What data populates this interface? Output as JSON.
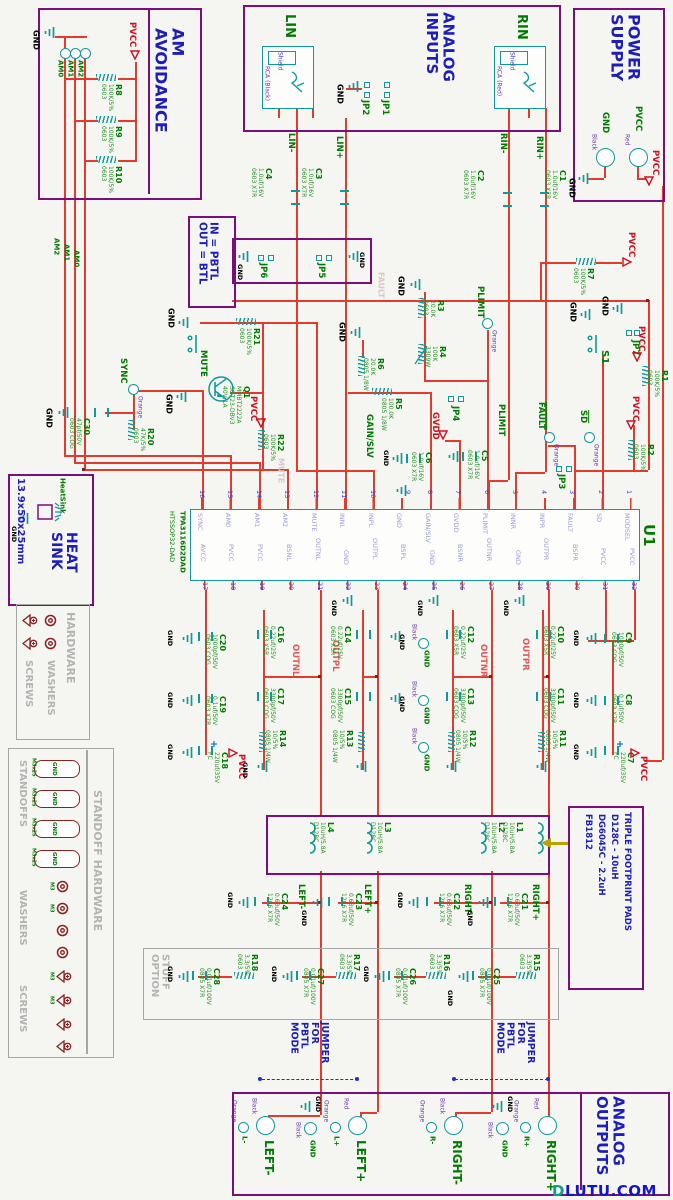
{
  "colors": {
    "wire": "#e23b2e",
    "symbol": "#0f9b9b",
    "block_border": "#7c0d7c",
    "title_blue": "#1d1dbb",
    "designator_green": "#007a00",
    "power_red": "#cf1020",
    "gray": "#a6a6a6",
    "hardware_red": "#8b2020",
    "jumper_blue": "#2a2ac8",
    "footprint_arrow": "#b8a400"
  },
  "watermark": {
    "d": "D",
    "rest": "LUTU.COM"
  },
  "titles": {
    "am": "AM\nAVOIDANCE",
    "inputs": "ANALOG\nINPUTS",
    "power": "POWER\nSUPPLY",
    "pbtl": "IN = PBTL\nOUT = BTL",
    "heat": "HEAT\nSINK",
    "heat_sub": "13.9x50x25mm",
    "heat_tag": "HeatSink",
    "hardware": "HARDWARE",
    "washers": "WASHERS",
    "screws": "SCREWS",
    "standoff": "STANDOFF HARDWARE",
    "standoffs": "STANDOFFS",
    "stuff": "STUFF\nOPTION",
    "jumper": "JUMPER\nFOR\nPBTL\nMODE",
    "outputs": "ANALOG\nOUTPUTS",
    "tfp1": "TRIPLE FOOTPRINT PADS",
    "tfp2": "D128C - 10uH",
    "tfp3": "DG6045C - 2.2uH",
    "tfp4": "FB1812",
    "m3": "M3",
    "m3x25": "M3x25"
  },
  "nets": {
    "gnd": "GND",
    "pvcc": "PVCC",
    "gvdd": "GVDD",
    "linn": "LIN-",
    "linp": "LIN+",
    "rinn": "RIN-",
    "rinp": "RIN+",
    "am0": "AM0",
    "am1": "AM1",
    "am2": "AM2",
    "outnl": "OUTNL",
    "outpl": "OUTPL",
    "outnr": "OUTNR",
    "outpr": "OUTPR",
    "leftn": "LEFT-",
    "leftp": "LEFT+",
    "rightn": "RIGHT-",
    "rightp": "RIGHT+",
    "gain": "GAIN/SLV",
    "plimit": "PLIMIT",
    "mute": "MUTE",
    "sync": "SYNC",
    "sd": "SD",
    "fault": "FAULT",
    "ln": "L-",
    "lp": "L+",
    "rn": "R-",
    "rp": "R+"
  },
  "tp_colors": {
    "orange": "Orange",
    "black": "Black",
    "red": "Red"
  },
  "rca": {
    "lin": "LIN",
    "rin": "RIN",
    "shield": "Shield",
    "black": "RCA (Black)",
    "red": "RCA (Red)"
  },
  "u1": {
    "r": "U1",
    "part": "TPA3116D2DAD",
    "pkg": "HTSSOP32-DAD",
    "top": [
      {
        "n": "16",
        "s": "SYNC"
      },
      {
        "n": "15",
        "s": "AM0"
      },
      {
        "n": "14",
        "s": "AM1"
      },
      {
        "n": "13",
        "s": "AM2"
      },
      {
        "n": "12",
        "s": "MUTE"
      },
      {
        "n": "11",
        "s": "INNL"
      },
      {
        "n": "10",
        "s": "INPL"
      },
      {
        "n": "9",
        "s": "GND"
      },
      {
        "n": "8",
        "s": "GAIN/SLV"
      },
      {
        "n": "7",
        "s": "GVDD"
      },
      {
        "n": "6",
        "s": "PLIMIT"
      },
      {
        "n": "5",
        "s": "INNR"
      },
      {
        "n": "4",
        "s": "INPR"
      },
      {
        "n": "3",
        "s": "FAULT"
      },
      {
        "n": "2",
        "s": "SD"
      },
      {
        "n": "1",
        "s": "MODSEL"
      }
    ],
    "bot": [
      {
        "n": "17",
        "s": "AVCC"
      },
      {
        "n": "18",
        "s": "PVCC"
      },
      {
        "n": "19",
        "s": "PVCC"
      },
      {
        "n": "20",
        "s": "BSNL"
      },
      {
        "n": "21",
        "s": "OUTNL"
      },
      {
        "n": "22",
        "s": "GND"
      },
      {
        "n": "23",
        "s": "OUTPL"
      },
      {
        "n": "24",
        "s": "BSPL"
      },
      {
        "n": "25",
        "s": "GND"
      },
      {
        "n": "26",
        "s": "BSNR"
      },
      {
        "n": "27",
        "s": "OUTNR"
      },
      {
        "n": "28",
        "s": "GND"
      },
      {
        "n": "29",
        "s": "OUTPR"
      },
      {
        "n": "30",
        "s": "BSPR"
      },
      {
        "n": "31",
        "s": "PVCC"
      },
      {
        "n": "32",
        "s": "PVCC"
      }
    ]
  },
  "components": {
    "R1": {
      "r": "R1",
      "v": "100K/5%\n0603"
    },
    "R2": {
      "r": "R2",
      "v": "100K/5%\n0603"
    },
    "R3": {
      "r": "R3",
      "v": "20.0K\n0603"
    },
    "R4": {
      "r": "R4",
      "v": "100K\n3309W"
    },
    "R5": {
      "r": "R5",
      "v": "100.0K\n0805 1/8W"
    },
    "R6": {
      "r": "R6",
      "v": "20.0K\n0805 1/8W"
    },
    "R7": {
      "r": "R7",
      "v": "100K/5%\n0603"
    },
    "R8": {
      "r": "R8",
      "v": "100K/5%\n0603"
    },
    "R9": {
      "r": "R9",
      "v": "100K/5%\n0603"
    },
    "R10": {
      "r": "R10",
      "v": "100K/5%\n0603"
    },
    "R11": {
      "r": "R11",
      "v": "10/5%\n0805 1/4W"
    },
    "R12": {
      "r": "R12",
      "v": "10/5%\n0805 1/4W"
    },
    "R13": {
      "r": "R13",
      "v": "10/5%\n0805 1/4W"
    },
    "R14": {
      "r": "R14",
      "v": "10/5%\n0805 1/4W"
    },
    "R15": {
      "r": "R15",
      "v": "3.3/5%\n0603"
    },
    "R16": {
      "r": "R16",
      "v": "3.3/5%\n0603"
    },
    "R17": {
      "r": "R17",
      "v": "3.3/5%\n0603"
    },
    "R18": {
      "r": "R18",
      "v": "3.3/5%\n0603"
    },
    "R20": {
      "r": "R20",
      "v": "47K/5%\n0603"
    },
    "R21": {
      "r": "R21",
      "v": "100K/5%\n0603"
    },
    "R22": {
      "r": "R22",
      "v": "100K/5%\n0603"
    },
    "C1": {
      "r": "C1",
      "v": "1.0uf/16V\n0603 X7R"
    },
    "C2": {
      "r": "C2",
      "v": "1.0uf/16V\n0603 X7R"
    },
    "C3": {
      "r": "C3",
      "v": "1.0uf/16V\n0603 X7R"
    },
    "C4": {
      "r": "C4",
      "v": "1.0uf/16V\n0603 X7R"
    },
    "C5": {
      "r": "C5",
      "v": "1.0uf/16V\n0603 X7R"
    },
    "C6": {
      "r": "C6",
      "v": "1.0uf/16V\n0603 X7R"
    },
    "C7": {
      "r": "C7",
      "v": "220uf/35V\nFC"
    },
    "C8": {
      "r": "C8",
      "v": "0.1uf/50V\n0603 X7R"
    },
    "C9": {
      "r": "C9",
      "v": "1000pf/50V\n0603 COG"
    },
    "C10": {
      "r": "C10",
      "v": "0.22uf/25V\n0603 X5R"
    },
    "C11": {
      "r": "C11",
      "v": "3300pf/50V\n0603 COG"
    },
    "C12": {
      "r": "C12",
      "v": "0.22uf/25V\n0603 X5R"
    },
    "C13": {
      "r": "C13",
      "v": "3300pf/50V\n0603 COG"
    },
    "C14": {
      "r": "C14",
      "v": "0.22uf/25V\n0603 X5R"
    },
    "C15": {
      "r": "C15",
      "v": "3300pf/50V\n0603 COG"
    },
    "C16": {
      "r": "C16",
      "v": "0.22uf/25V\n0603 X5R"
    },
    "C17": {
      "r": "C17",
      "v": "3300pf/50V\n0603 COG"
    },
    "C18": {
      "r": "C18",
      "v": "220uf/35V\nFC"
    },
    "C19": {
      "r": "C19",
      "v": "0.1uf/50V\n0603 X7R"
    },
    "C20": {
      "r": "C20",
      "v": "1000pf/50V\n0603 COG"
    },
    "C21": {
      "r": "C21",
      "v": "0.68uf/50V\n1206 X7R"
    },
    "C22": {
      "r": "C22",
      "v": "0.68uf/50V\n1206 X7R"
    },
    "C23": {
      "r": "C23",
      "v": "0.68uf/50V\n1206 X7R"
    },
    "C24": {
      "r": "C24",
      "v": "0.68uf/50V\n1206 X7R"
    },
    "C25": {
      "r": "C25",
      "v": "0.01uf/100V\n0805 X7R"
    },
    "C26": {
      "r": "C26",
      "v": "0.01uf/100V\n0805 X7R"
    },
    "C27": {
      "r": "C27",
      "v": "0.01uf/100V\n0805 X7R"
    },
    "C28": {
      "r": "C28",
      "v": "0.01uf/100V\n0805 X7R"
    },
    "C30": {
      "r": "C30",
      "v": "47pf/50V\n0603 COG"
    },
    "L1": {
      "r": "L1",
      "v": "10uH/5.8A\nD128C"
    },
    "L2": {
      "r": "L2",
      "v": "10uH/5.8A\nD128C"
    },
    "L3": {
      "r": "L3",
      "v": "10uH/5.8A\nD128C"
    },
    "L4": {
      "r": "L4",
      "v": "10uH/5.8A\nD128C"
    },
    "Q1": {
      "r": "Q1",
      "v": "MMBT2222A\nSOT23-DBV3\n40V,1A"
    },
    "JP1": {
      "r": "JP1"
    },
    "JP2": {
      "r": "JP2"
    },
    "JP3": {
      "r": "JP3"
    },
    "JP4": {
      "r": "JP4"
    },
    "JP5": {
      "r": "JP5"
    },
    "JP6": {
      "r": "JP6"
    },
    "JP7": {
      "r": "JP7"
    },
    "S1": {
      "r": "S1"
    }
  }
}
